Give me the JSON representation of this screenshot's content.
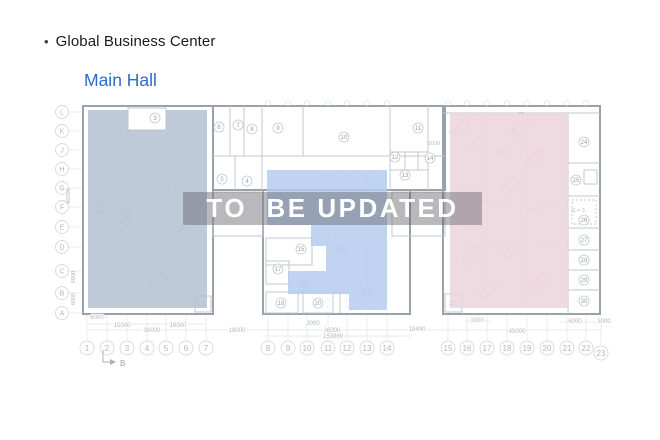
{
  "header": {
    "bullet": "•",
    "title": "Global Business Center",
    "subtitle": "Main Hall"
  },
  "watermark": {
    "text": "TO  BE UPDATED"
  },
  "colors": {
    "accent_blue": "#2a6cc6",
    "title_text": "#1b1b1d",
    "zone_left": "#b4c1d2",
    "zone_center": "#b5cdee",
    "zone_right": "#ecd4dc",
    "watermark_band": "rgba(100,100,106,0.45)",
    "watermark_text": "#ffffff"
  },
  "plan": {
    "row_labels": [
      {
        "t": "L",
        "y": 112
      },
      {
        "t": "K",
        "y": 131
      },
      {
        "t": "J",
        "y": 150
      },
      {
        "t": "H",
        "y": 169
      },
      {
        "t": "G",
        "y": 188
      },
      {
        "t": "F",
        "y": 207
      },
      {
        "t": "E",
        "y": 227
      },
      {
        "t": "D",
        "y": 247
      },
      {
        "t": "C",
        "y": 271
      },
      {
        "t": "B",
        "y": 293
      },
      {
        "t": "A",
        "y": 313
      }
    ],
    "col_labels": [
      {
        "t": "1",
        "x": 87
      },
      {
        "t": "2",
        "x": 107
      },
      {
        "t": "3",
        "x": 127
      },
      {
        "t": "4",
        "x": 147
      },
      {
        "t": "5",
        "x": 166
      },
      {
        "t": "6",
        "x": 186
      },
      {
        "t": "7",
        "x": 206
      },
      {
        "t": "8",
        "x": 268
      },
      {
        "t": "9",
        "x": 288
      },
      {
        "t": "10",
        "x": 307
      },
      {
        "t": "11",
        "x": 328
      },
      {
        "t": "12",
        "x": 347
      },
      {
        "t": "13",
        "x": 367
      },
      {
        "t": "14",
        "x": 387
      },
      {
        "t": "15",
        "x": 448
      },
      {
        "t": "16",
        "x": 467
      },
      {
        "t": "17",
        "x": 487
      },
      {
        "t": "18",
        "x": 507
      },
      {
        "t": "19",
        "x": 527
      },
      {
        "t": "20",
        "x": 547
      },
      {
        "t": "21",
        "x": 567
      },
      {
        "t": "22",
        "x": 586
      },
      {
        "t": "23",
        "x": 601,
        "y": 353
      }
    ],
    "rooms": [
      {
        "t": "2",
        "x": 126,
        "y": 212
      },
      {
        "t": "3",
        "x": 155,
        "y": 118
      },
      {
        "t": "4",
        "x": 247,
        "y": 181
      },
      {
        "t": "5",
        "x": 222,
        "y": 179
      },
      {
        "t": "6",
        "x": 219,
        "y": 127
      },
      {
        "t": "7",
        "x": 238,
        "y": 125
      },
      {
        "t": "8",
        "x": 252,
        "y": 129
      },
      {
        "t": "9",
        "x": 278,
        "y": 128
      },
      {
        "t": "10",
        "x": 344,
        "y": 137
      },
      {
        "t": "11",
        "x": 418,
        "y": 128
      },
      {
        "t": "12",
        "x": 395,
        "y": 157
      },
      {
        "t": "13",
        "x": 405,
        "y": 175
      },
      {
        "t": "14",
        "x": 430,
        "y": 158
      },
      {
        "t": "15",
        "x": 301,
        "y": 249
      },
      {
        "t": "17",
        "x": 278,
        "y": 269
      },
      {
        "t": "18",
        "x": 281,
        "y": 303
      },
      {
        "t": "19",
        "x": 303,
        "y": 286
      },
      {
        "t": "20",
        "x": 318,
        "y": 303
      },
      {
        "t": "21",
        "x": 342,
        "y": 250
      },
      {
        "t": "22",
        "x": 367,
        "y": 293
      },
      {
        "t": "24",
        "x": 584,
        "y": 142
      },
      {
        "t": "25",
        "x": 576,
        "y": 180
      },
      {
        "t": "26",
        "x": 584,
        "y": 220
      },
      {
        "t": "27",
        "x": 584,
        "y": 240
      },
      {
        "t": "28",
        "x": 584,
        "y": 260
      },
      {
        "t": "29",
        "x": 584,
        "y": 280
      },
      {
        "t": "30",
        "x": 584,
        "y": 301
      }
    ],
    "rooms_plain": [
      {
        "t": "1",
        "x": 203,
        "y": 306
      },
      {
        "t": "23",
        "x": 521,
        "y": 116
      },
      {
        "t": "31",
        "x": 486,
        "y": 203
      },
      {
        "t": "32",
        "x": 452,
        "y": 305
      }
    ],
    "annotations": [
      {
        "t": "Q + 3",
        "x": 173,
        "y": 185
      },
      {
        "t": "2000",
        "x": 100,
        "y": 214
      },
      {
        "t": "Q = 3",
        "x": 357,
        "y": 246
      },
      {
        "t": "1800",
        "x": 502,
        "y": 154
      },
      {
        "t": "Q = 3",
        "x": 534,
        "y": 212
      },
      {
        "t": "Q = 3",
        "x": 476,
        "y": 229
      },
      {
        "t": "Q = 3",
        "x": 578,
        "y": 212
      },
      {
        "t": "1000",
        "x": 434,
        "y": 145
      },
      {
        "t": "45°",
        "x": 453,
        "y": 134
      },
      {
        "t": "45°",
        "x": 515,
        "y": 132
      }
    ],
    "dimensions": [
      {
        "t": "6000",
        "x": 97,
        "y": 319
      },
      {
        "t": "15000",
        "x": 122,
        "y": 327
      },
      {
        "t": "18000",
        "x": 178,
        "y": 327
      },
      {
        "t": "2000",
        "x": 313,
        "y": 325
      },
      {
        "t": "1000",
        "x": 477,
        "y": 322
      },
      {
        "t": "6000",
        "x": 575,
        "y": 323
      },
      {
        "t": "3000",
        "x": 604,
        "y": 323
      },
      {
        "t": "36000",
        "x": 152,
        "y": 332
      },
      {
        "t": "18000",
        "x": 237,
        "y": 332
      },
      {
        "t": "36000",
        "x": 332,
        "y": 332
      },
      {
        "t": "18400",
        "x": 417,
        "y": 331
      },
      {
        "t": "45000",
        "x": 517,
        "y": 333
      },
      {
        "t": "153869",
        "x": 333,
        "y": 338
      }
    ],
    "v_dimensions": [
      {
        "t": "60000",
        "x": 70,
        "y": 196
      },
      {
        "t": "6000",
        "x": 75,
        "y": 277
      },
      {
        "t": "6000",
        "x": 75,
        "y": 299
      }
    ],
    "section_marker": "B"
  }
}
